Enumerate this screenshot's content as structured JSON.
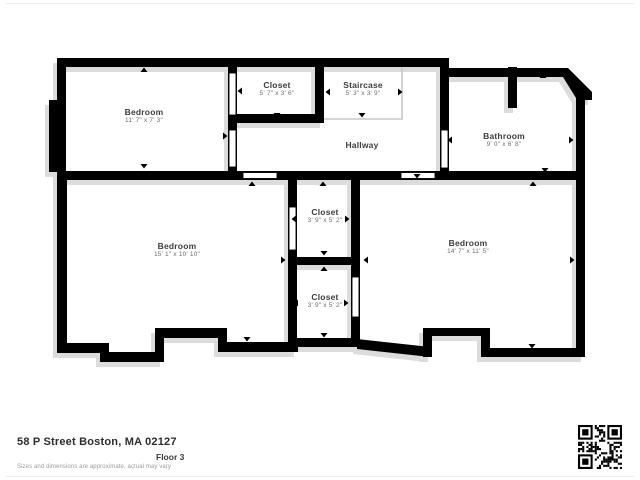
{
  "plan": {
    "rooms": [
      {
        "id": "bedroom-1",
        "name": "Bedroom",
        "dims": "11' 7\" x 7' 3\""
      },
      {
        "id": "closet-1",
        "name": "Closet",
        "dims": "5' 7\" x 3' 6\""
      },
      {
        "id": "staircase",
        "name": "Staircase",
        "dims": "5' 3\" x 3' 9\""
      },
      {
        "id": "hallway",
        "name": "Hallway",
        "dims": ""
      },
      {
        "id": "bathroom",
        "name": "Bathroom",
        "dims": "9' 0\" x 6' 8\""
      },
      {
        "id": "bedroom-2",
        "name": "Bedroom",
        "dims": "15' 1\" x 10' 10\""
      },
      {
        "id": "closet-2",
        "name": "Closet",
        "dims": "3' 9\" x 5' 2\""
      },
      {
        "id": "closet-3",
        "name": "Closet",
        "dims": "3' 9\" x 5' 2\""
      },
      {
        "id": "bedroom-3",
        "name": "Bedroom",
        "dims": "14' 7\" x 11' 5\""
      }
    ]
  },
  "footer": {
    "address": "58 P Street Boston, MA 02127",
    "floor_label": "Floor 3",
    "disclaimer": "Sizes and dimensions are approximate, actual may vary"
  },
  "colors": {
    "wall": "#000000",
    "shadow": "#dcdcdc",
    "stair_outline": "#c7c7c7",
    "room_name": "#3c3c3c",
    "room_dims": "#6f6f6f"
  }
}
